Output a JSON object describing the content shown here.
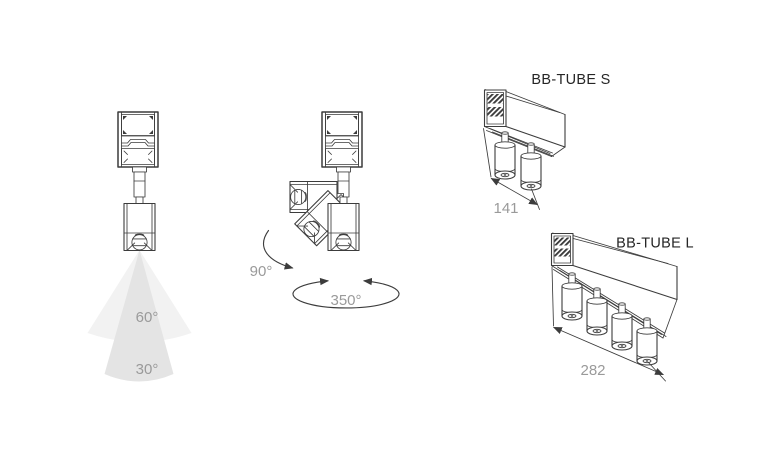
{
  "diagram": {
    "beam_figure": {
      "wide_beam_angle": "60°",
      "narrow_beam_angle": "30°"
    },
    "rotation_figure": {
      "tilt_angle": "90°",
      "rotation_angle": "350°"
    },
    "bb_tube_s": {
      "title": "BB-TUBE S",
      "length_mm": "141"
    },
    "bb_tube_l": {
      "title": "BB-TUBE L",
      "length_mm": "282"
    }
  },
  "colors": {
    "line": "#3c3c3c",
    "muted": "#9a9a9a",
    "title": "#262626",
    "cone_light": "#f2f2f2",
    "cone_dark": "#e4e4e4",
    "bg": "#ffffff"
  }
}
